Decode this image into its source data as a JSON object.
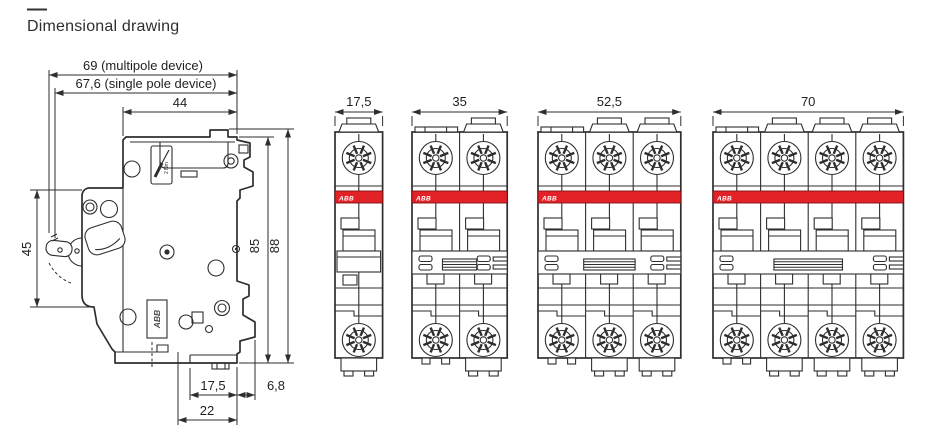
{
  "header": {
    "dash": "—",
    "title": "Dimensional drawing"
  },
  "colors": {
    "line": "#2e2e2e",
    "band_red": "#e32228",
    "band_text": "#ffffff"
  },
  "side_view": {
    "dim_width_multipole": "69 (multipole device)",
    "dim_width_singlepole": "67,6 (single pole device)",
    "dim_upper_depth": "44",
    "dim_front_height": "45",
    "dim_body_height": "85",
    "dim_total_height": "88",
    "dim_din_slot": "17,5",
    "dim_clip_protrusion": "6,8",
    "dim_lower_depth": "22",
    "torque_label": "2 Nm",
    "brand_label": "ABB"
  },
  "front_views": [
    {
      "name": "1-pole front view",
      "poles": 1,
      "width_label": "17,5",
      "brand": "ABB"
    },
    {
      "name": "2-pole front view",
      "poles": 2,
      "width_label": "35",
      "brand": "ABB"
    },
    {
      "name": "3-pole front view",
      "poles": 3,
      "width_label": "52,5",
      "brand": "ABB"
    },
    {
      "name": "4-pole front view",
      "poles": 4,
      "width_label": "70",
      "brand": "ABB"
    }
  ]
}
